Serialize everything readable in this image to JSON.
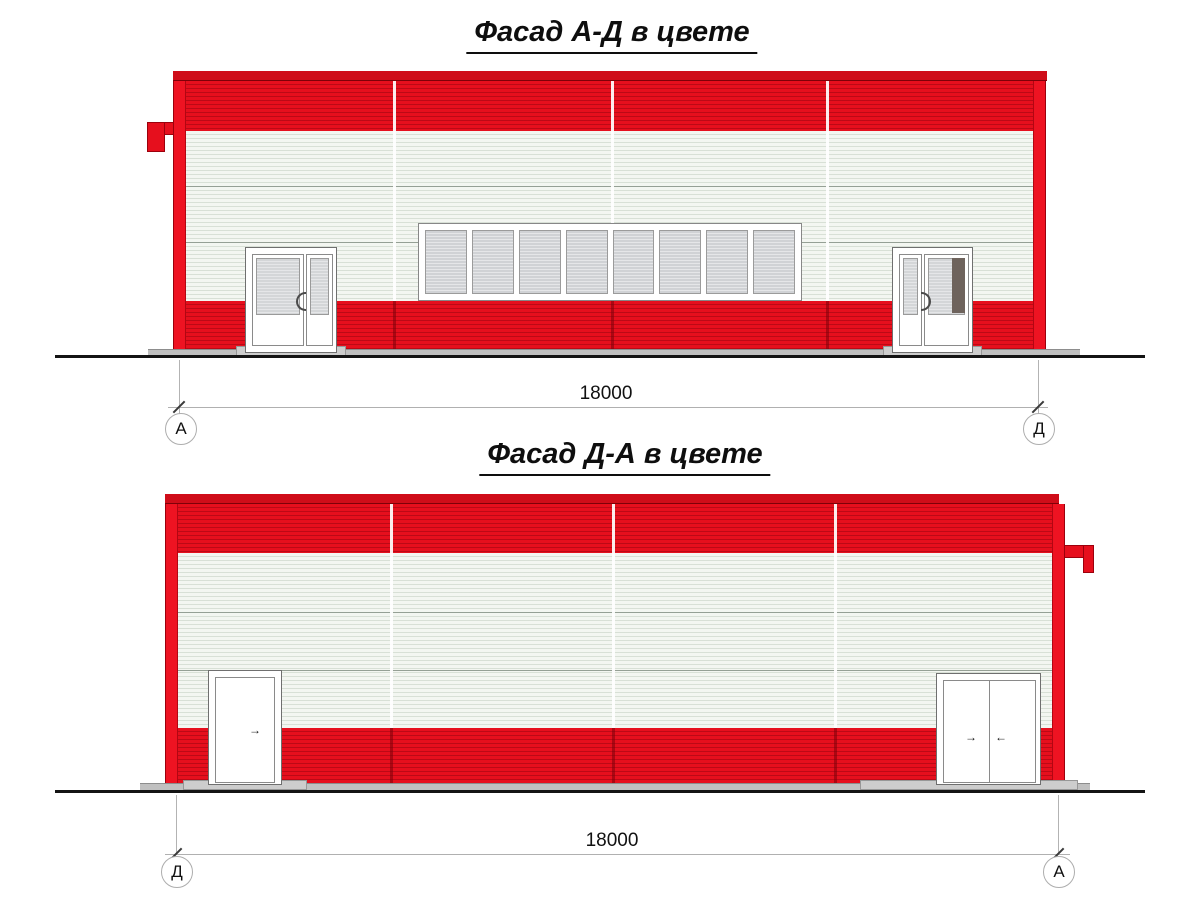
{
  "drawing": {
    "facade_ad": {
      "title": "Фасад А-Д в цвете",
      "dimension": "18000",
      "axis_left": "А",
      "axis_right": "Д"
    },
    "facade_da": {
      "title": "Фасад Д-А в цвете",
      "dimension": "18000",
      "axis_left": "Д",
      "axis_right": "А"
    },
    "icons": {
      "swing_arrow_right": "→",
      "swing_arrow_left": "←"
    },
    "colors": {
      "facade_red": "#e60f1d",
      "roof_cap_red": "#cf0d19",
      "panel_white": "#f3f6f1",
      "glass_gray": "#d0d2d5",
      "dark_door_pane": "#6e635c",
      "ground_black": "#141414"
    }
  }
}
